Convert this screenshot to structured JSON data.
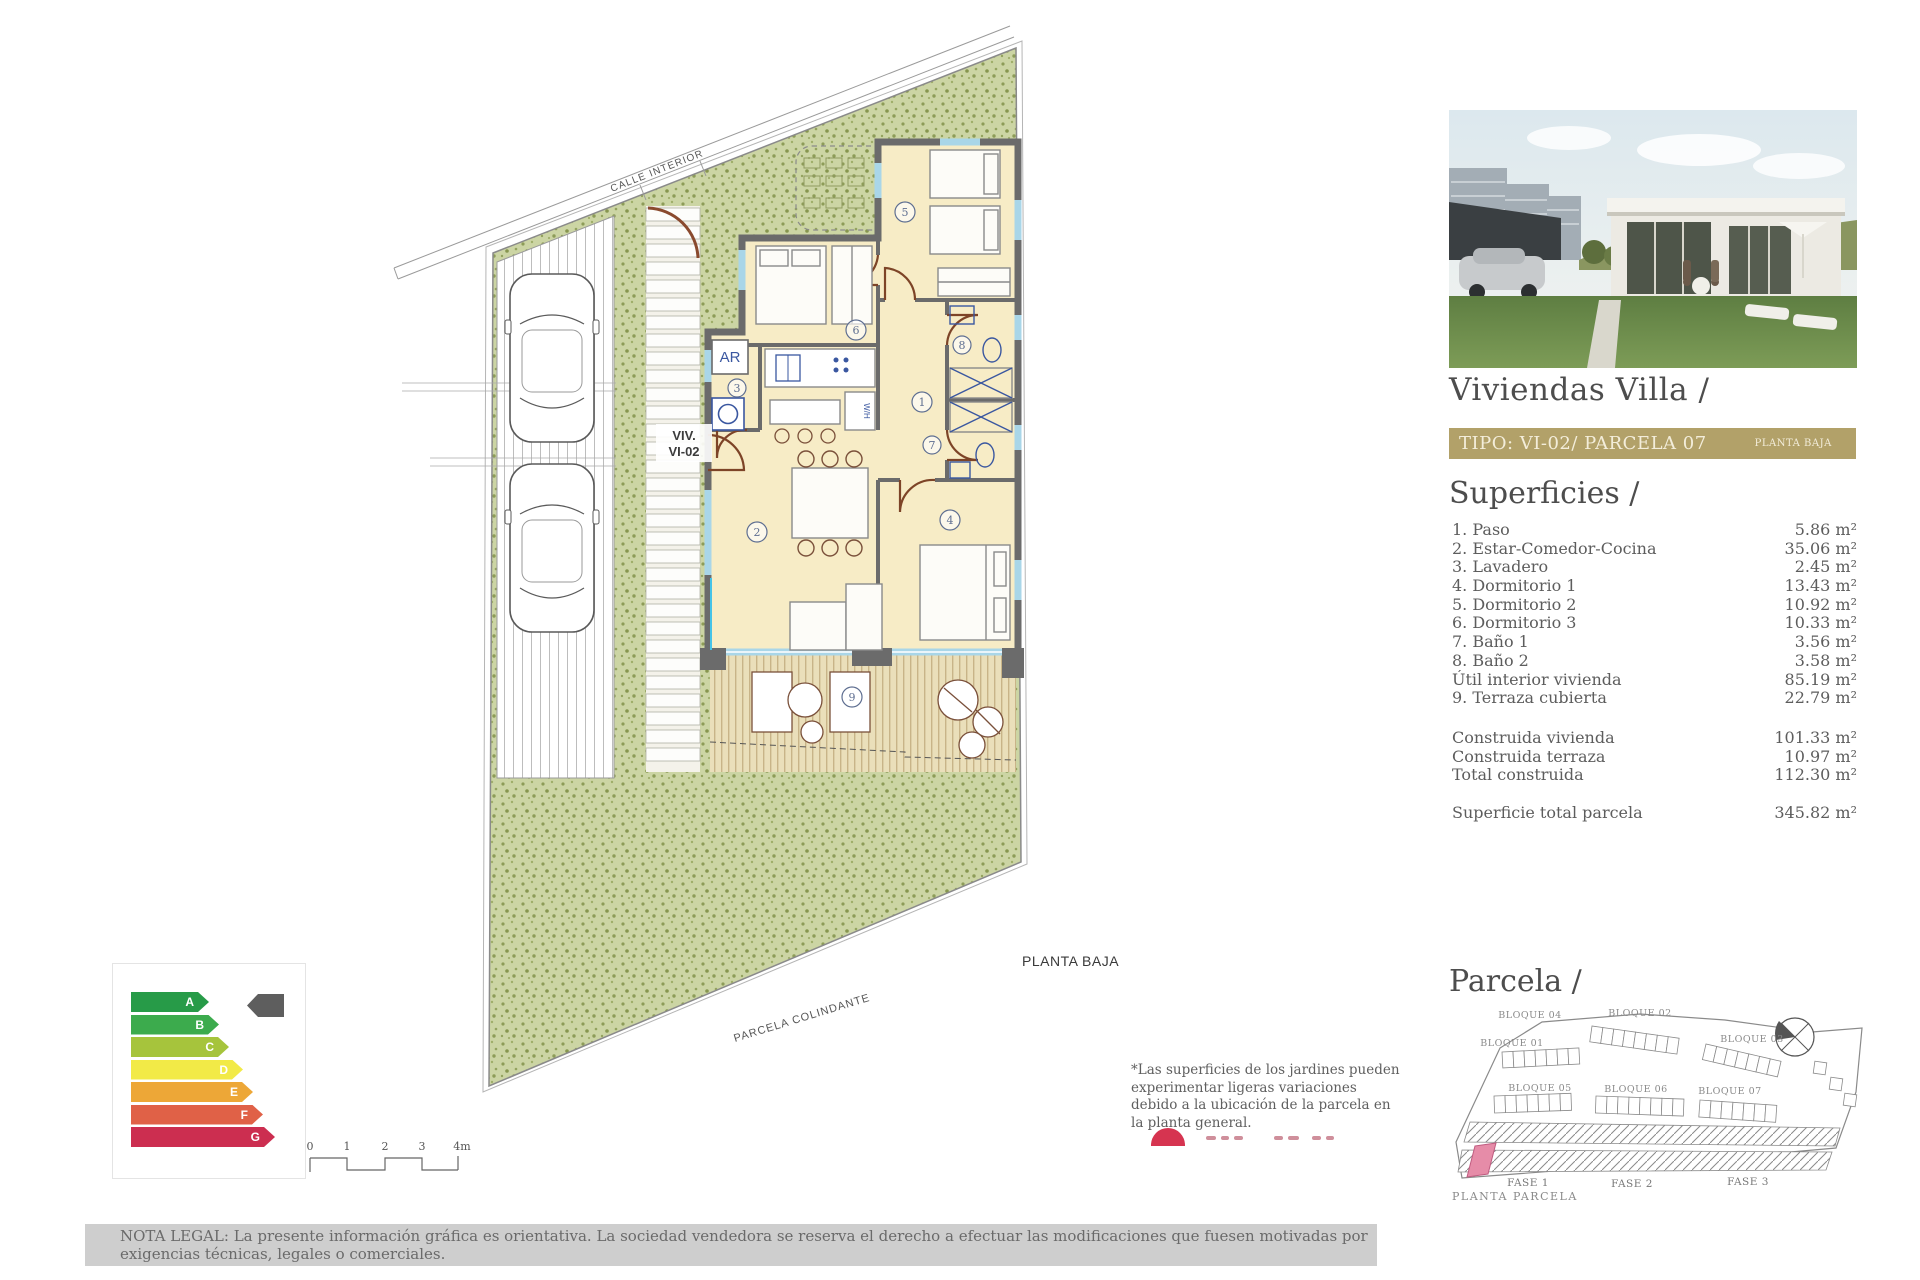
{
  "panel": {
    "title": "Viviendas Villa /",
    "type_bar": {
      "label": "TIPO: VI-02/ PARCELA 07",
      "floor": "PLANTA BAJA"
    },
    "superficies": {
      "heading": "Superficies /",
      "rows": [
        {
          "label": "1. Paso",
          "value": "5.86 m²"
        },
        {
          "label": "2. Estar-Comedor-Cocina",
          "value": "35.06 m²"
        },
        {
          "label": "3. Lavadero",
          "value": "2.45 m²"
        },
        {
          "label": "4. Dormitorio 1",
          "value": "13.43 m²"
        },
        {
          "label": "5. Dormitorio 2",
          "value": "10.92 m²"
        },
        {
          "label": "6. Dormitorio 3",
          "value": "10.33 m²"
        },
        {
          "label": "7. Baño 1",
          "value": "3.56 m²"
        },
        {
          "label": "8. Baño 2",
          "value": "3.58 m²"
        },
        {
          "label": "Útil interior vivienda",
          "value": "85.19 m²"
        },
        {
          "label": "9. Terraza cubierta",
          "value": "22.79 m²"
        }
      ],
      "totals": [
        {
          "label": "Construida vivienda",
          "value": "101.33 m²"
        },
        {
          "label": "Construida terraza",
          "value": "10.97 m²"
        },
        {
          "label": "Total construida",
          "value": "112.30 m²"
        }
      ],
      "parcel_total": {
        "label": "Superficie total parcela",
        "value": "345.82 m²"
      }
    },
    "parcela": {
      "heading": "Parcela /",
      "blocks": {
        "b01": "BLOQUE 01",
        "b02": "BLOQUE 02",
        "b03": "BLOQUE 03",
        "b04": "BLOQUE 04",
        "b05": "BLOQUE 05",
        "b06": "BLOQUE 06",
        "b07": "BLOQUE 07"
      },
      "fases": [
        "FASE 1",
        "FASE 2",
        "FASE 3"
      ],
      "caption": "PLANTA PARCELA"
    }
  },
  "plan": {
    "street_label": "CALLE INTERIOR",
    "unit_line1": "VIV.",
    "unit_line2": "VI-02",
    "ar_label": "AR",
    "wh_label": "W/H",
    "floor_caption": "PLANTA BAJA",
    "boundary_label": "PARCELA COLINDANTE",
    "rooms": [
      "1",
      "2",
      "3",
      "4",
      "5",
      "6",
      "7",
      "8",
      "9"
    ]
  },
  "scale": {
    "ticks": [
      "0",
      "1",
      "2",
      "3",
      "4m"
    ]
  },
  "energy": {
    "grades": [
      {
        "letter": "A",
        "color": "#279b48"
      },
      {
        "letter": "B",
        "color": "#3cab4d"
      },
      {
        "letter": "C",
        "color": "#a6c43c"
      },
      {
        "letter": "D",
        "color": "#f2ea47"
      },
      {
        "letter": "E",
        "color": "#eda737"
      },
      {
        "letter": "F",
        "color": "#e06147"
      },
      {
        "letter": "G",
        "color": "#cc2e50"
      }
    ]
  },
  "notes": {
    "jardines": "*Las superficies de los jardines pueden experimentar ligeras variaciones debido a la ubicación de la parcela en la planta general.",
    "legal": "NOTA LEGAL: La presente información gráfica es orientativa. La sociedad vendedora se reserva el derecho a efectuar las modificaciones que fuesen motivadas por exigencias técnicas, legales o comerciales."
  }
}
